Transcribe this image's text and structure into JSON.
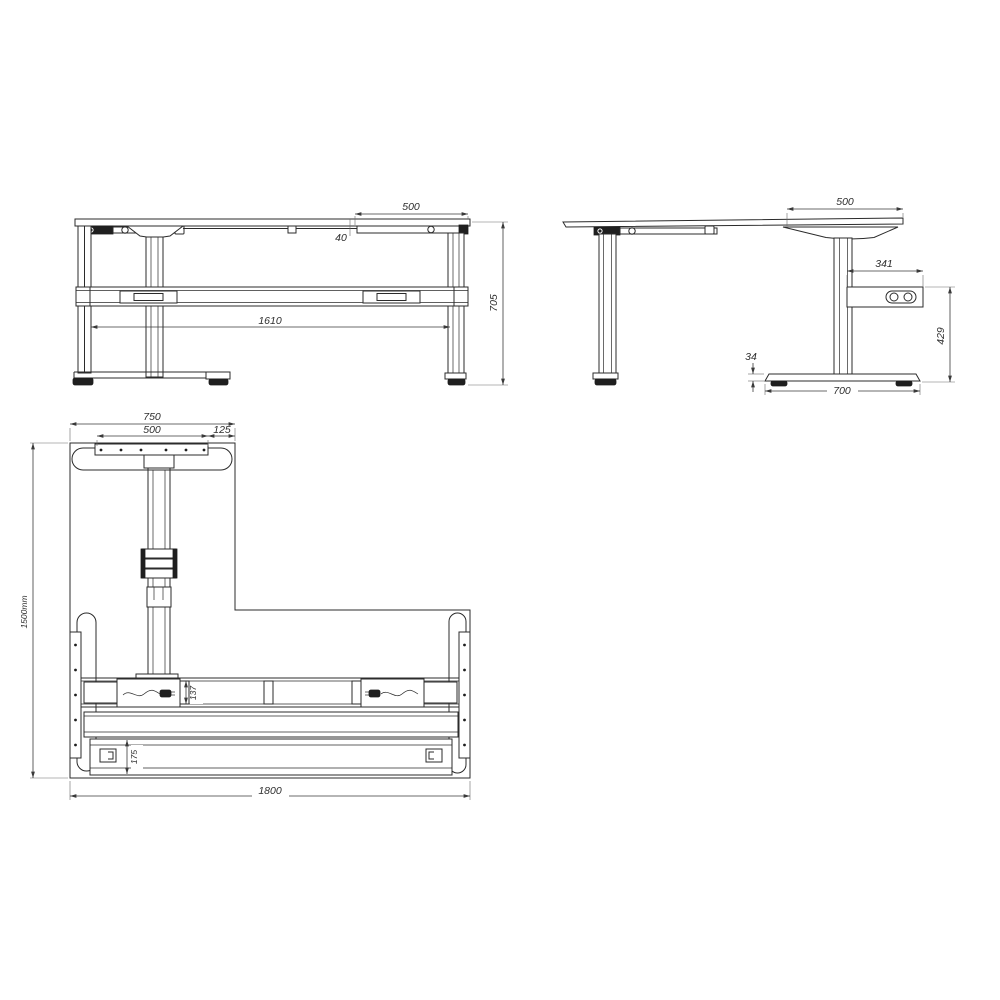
{
  "drawing": {
    "type": "technical-drawing",
    "subject": "height-adjustable L-shaped desk frame, three orthographic views",
    "colors": {
      "line": "#2b2b2b",
      "dimension": "#3a3a3a",
      "background": "#ffffff"
    },
    "views": {
      "front": {
        "name": "front-view",
        "dims": {
          "top_overhang": "500",
          "offset": "40",
          "frame_width": "1610",
          "height": "705"
        }
      },
      "side": {
        "name": "side-view",
        "dims": {
          "top_depth": "500",
          "control_box_width": "341",
          "box_to_floor": "429",
          "foot_height": "34",
          "foot_length": "700"
        }
      },
      "plan": {
        "name": "plan-view",
        "dims": {
          "foot_bracket": "750",
          "mounting_plate": "500",
          "edge_offset": "125",
          "depth": "1500mm",
          "width": "1800",
          "beam_depth": "137",
          "rail_depth": "175"
        }
      }
    }
  }
}
